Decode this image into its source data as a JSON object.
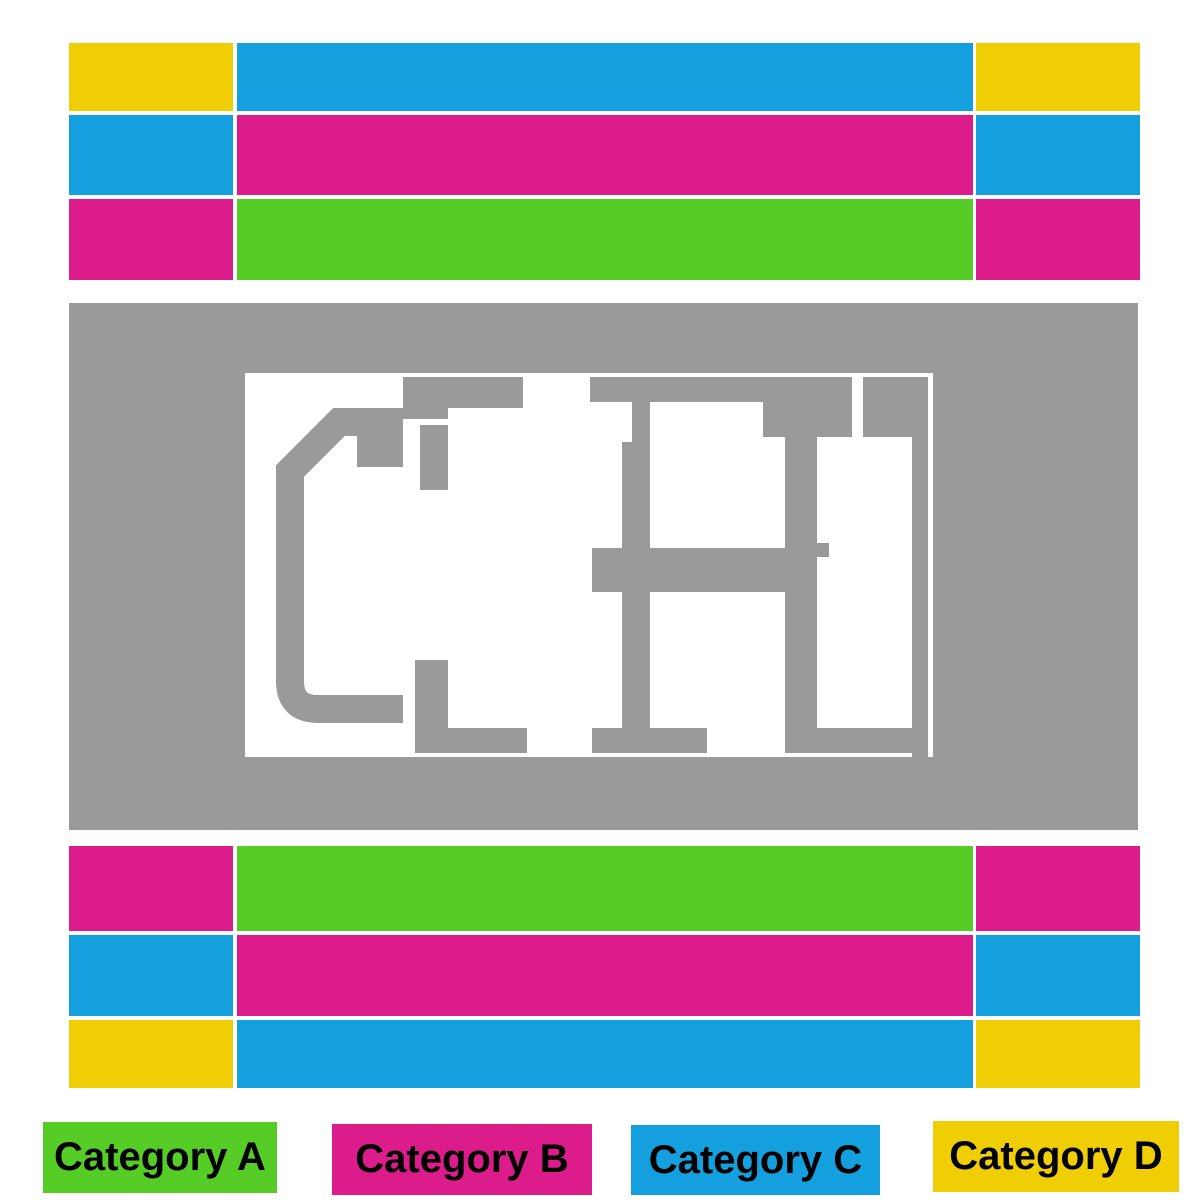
{
  "colors": {
    "category_a": "#56CC27",
    "category_b": "#DD1C8C",
    "category_c": "#14A0DF",
    "category_d": "#F0CE05",
    "map_gray": "#9A9A9A",
    "map_white": "#FFFFFF",
    "legend_text": "#000000",
    "page_background": "#FFFFFF"
  },
  "legend": {
    "items": [
      {
        "label": "Category A",
        "color": "category_a"
      },
      {
        "label": "Category B",
        "color": "category_b"
      },
      {
        "label": "Category C",
        "color": "category_c"
      },
      {
        "label": "Category D",
        "color": "category_d"
      }
    ]
  },
  "seat_bands": {
    "top": {
      "rows": [
        {
          "cells": [
            "category_d",
            "category_c",
            "category_d"
          ]
        },
        {
          "cells": [
            "category_c",
            "category_b",
            "category_c"
          ]
        },
        {
          "cells": [
            "category_b",
            "category_a",
            "category_b"
          ]
        }
      ]
    },
    "bottom": {
      "rows": [
        {
          "cells": [
            "category_b",
            "category_a",
            "category_b"
          ]
        },
        {
          "cells": [
            "category_c",
            "category_b",
            "category_c"
          ]
        },
        {
          "cells": [
            "category_d",
            "category_c",
            "category_d"
          ]
        }
      ]
    }
  },
  "map": {
    "name": "stage-floor-plan"
  }
}
